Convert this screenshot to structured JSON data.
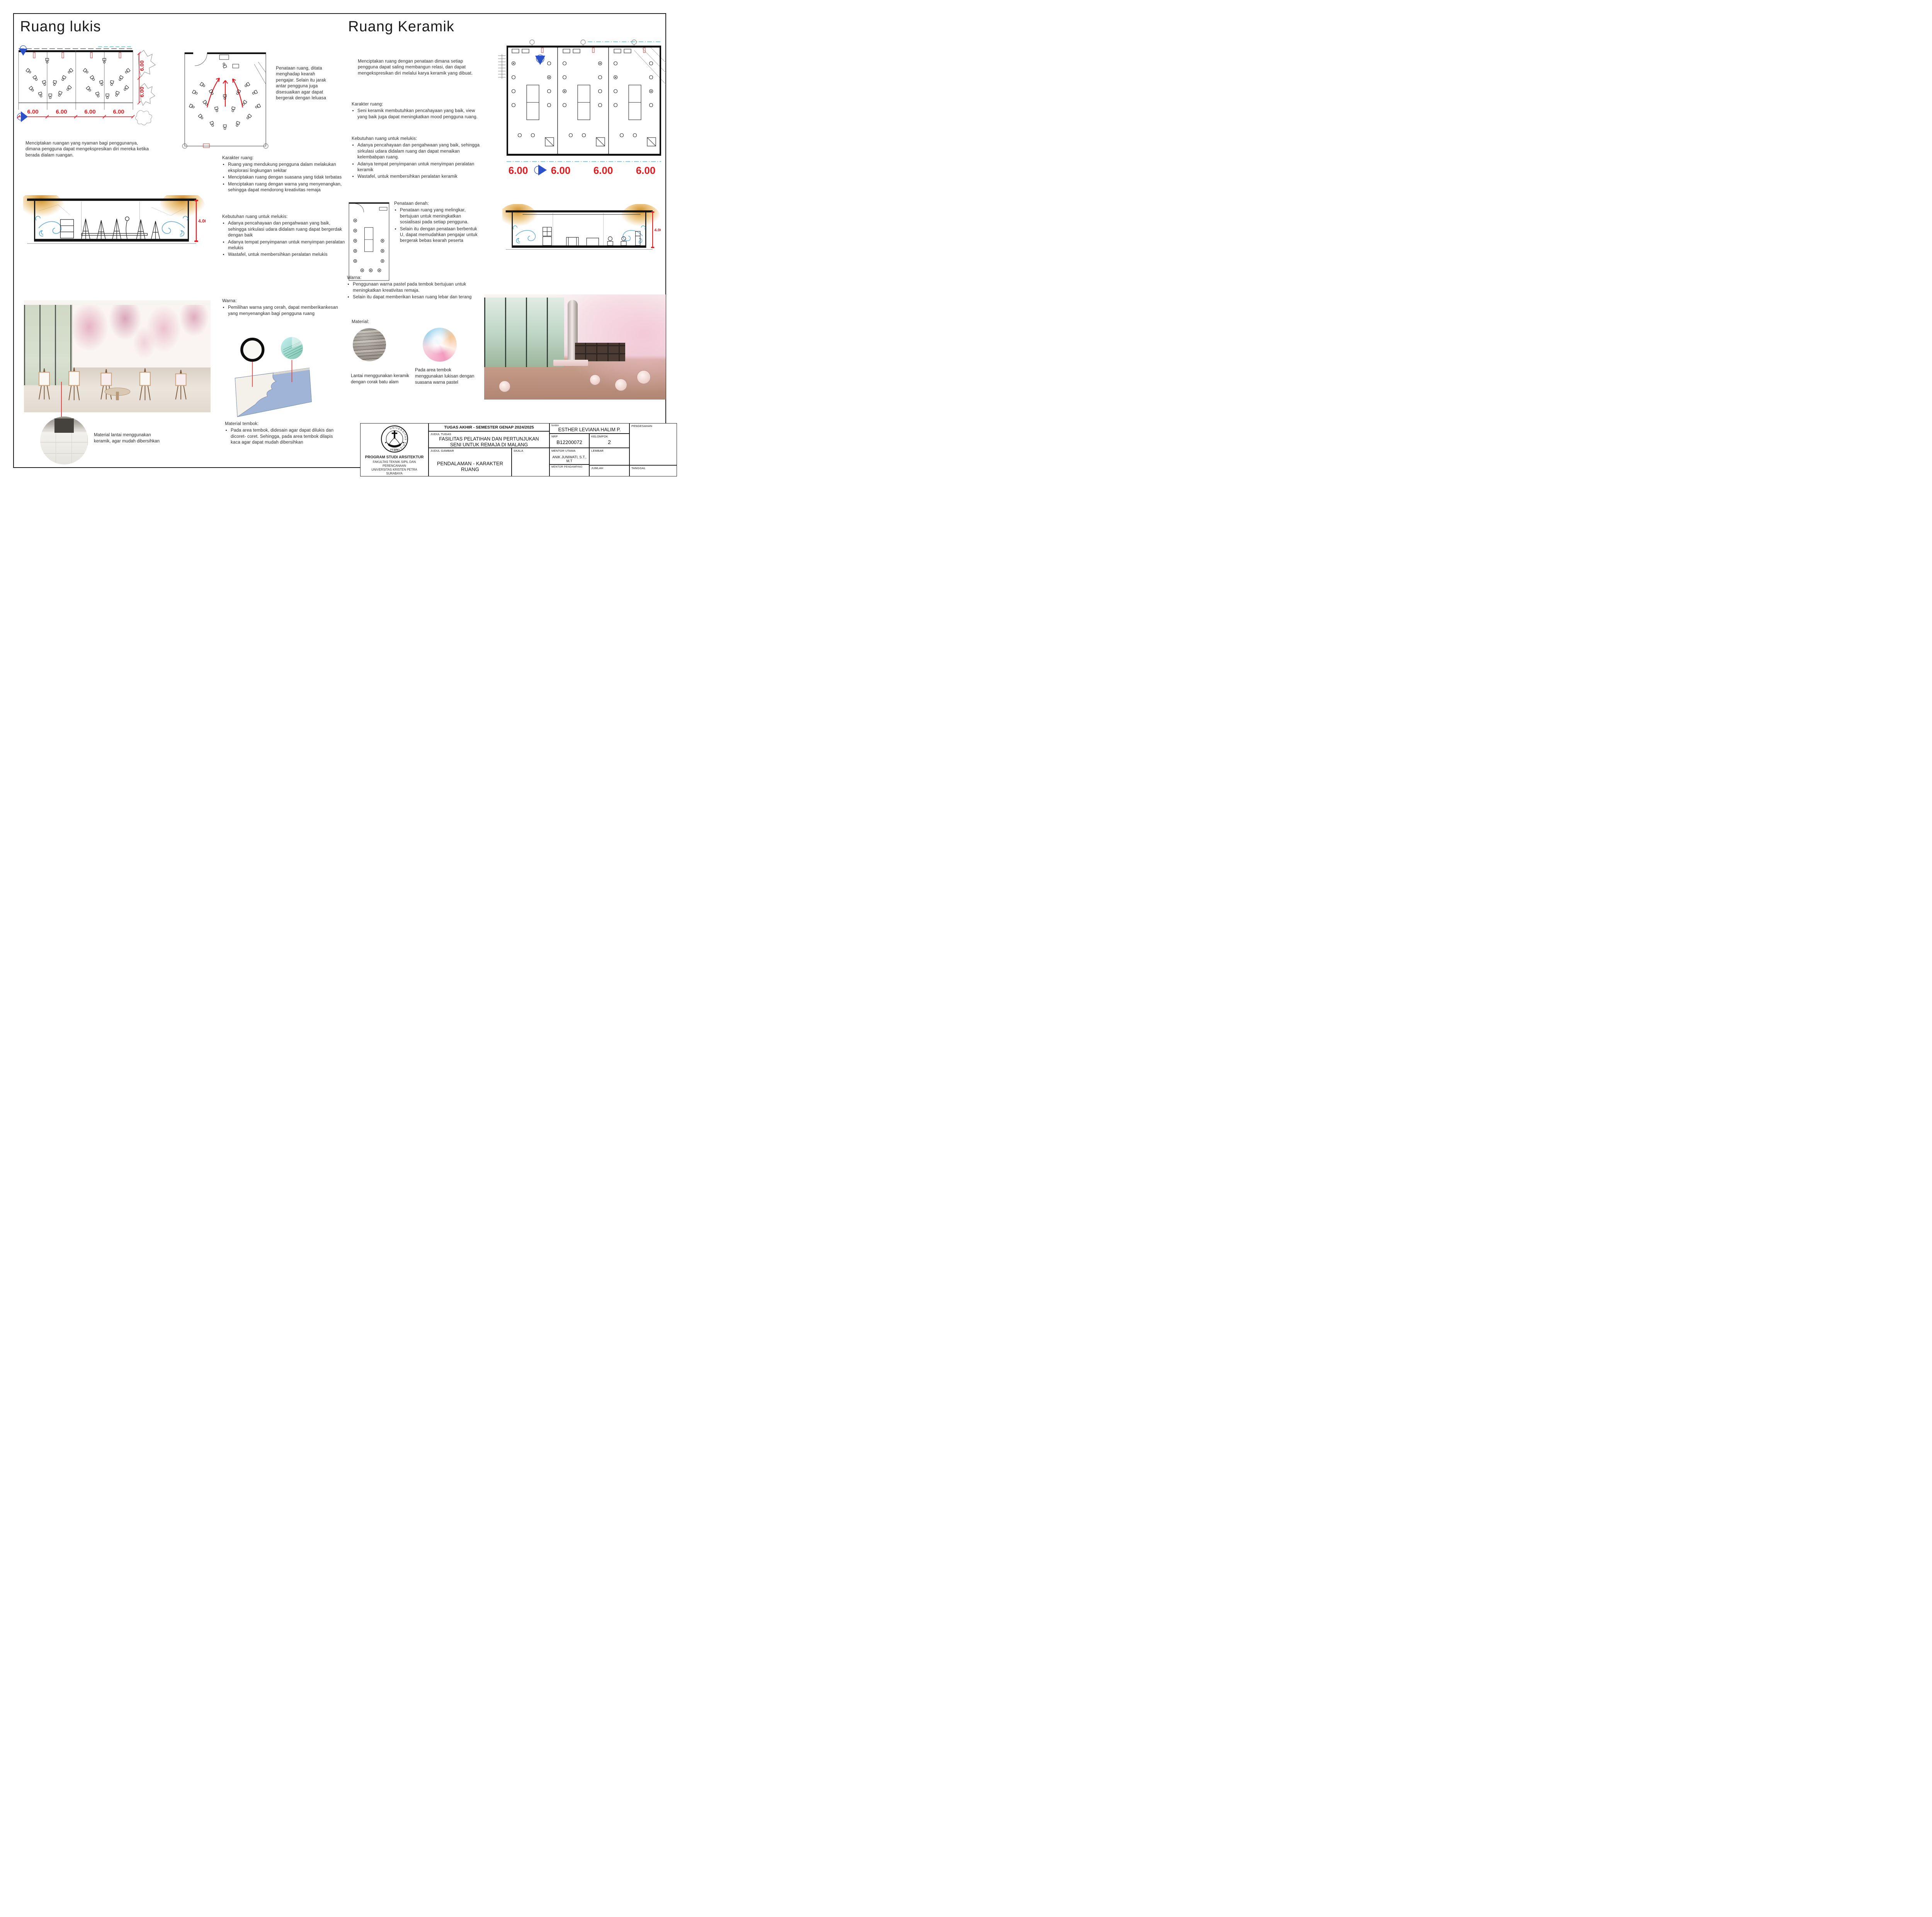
{
  "colors": {
    "dim_red": "#e8191f",
    "marker_blue": "#2b50c8",
    "wind_blue": "#5aa7d6",
    "glow_orange": "#dd8f1c",
    "panel_blue": "#9fb4d6",
    "glass_teal": "#9fd8cb"
  },
  "left": {
    "title": "Ruang lukis",
    "plan_dims": [
      "6.00",
      "6.00",
      "6.00",
      "6.00"
    ],
    "plan_vdims": [
      "6.00",
      "6.00"
    ],
    "intro": "Menciptakan ruangan yang nyaman bagi penggunanya, dimana pengguna dapat mengekspresikan diri mereka ketika berada dialam ruangan.",
    "annotation": "Penataan ruang, ditata menghadap kearah pengajar. Selain itu jarak antar pengguna juga disesuaikan agar dapat bergerak dengan leluasa",
    "section_dim": "4.00",
    "karakter": {
      "heading": "Karakter ruang:",
      "items": [
        "Ruang yang mendukung pengguna dalam melakukan eksplorasi lingkungan sekitar",
        "Menciptakan ruang dengan suasana yang tidak terbatas",
        "Menciptakan ruang dengan warna yang menyenangkan, sehingga dapat mendorong kreativitas remaja"
      ]
    },
    "kebutuhan": {
      "heading": "Kebutuhan ruang untuk melukis:",
      "items": [
        "Adanya pencahayaan dan pengahwaan yang baik, sehingga sirkulasi udara didalam ruang dapat bergerdak dengan baik",
        "Adanya tempat penyimpanan untuk menyimpan peralatan melukis",
        "Wastafel, untuk membersihkan peralatan melukis"
      ]
    },
    "warna": {
      "heading": "Warna:",
      "items": [
        "Pemilihan warna yang cerah, dapat memberikankesan yang menyenangkan bagi pengguna ruang"
      ]
    },
    "material_tembok": {
      "heading": "Material tembok:",
      "items": [
        "Pada area tembok, didesain agar dapat dilukis dan dicoret- coret. Sehingga, pada area tembok dilapis kaca agar dapat mudah dibersihkan"
      ]
    },
    "material_lantai": "Material lantai menggunakan keramik, agar mudah dibersihkan"
  },
  "right": {
    "title": "Ruang Keramik",
    "plan_dims": [
      "6.00",
      "6.00",
      "6.00",
      "6.00"
    ],
    "intro": "Menciptakan ruang dengan penataan dimana setiap pengguna dapat saling membangun relasi, dan dapat mengekspresikan diri melalui karya keramik yang dibuat.",
    "section_dim": "4.00",
    "karakter": {
      "heading": "Karakter ruang:",
      "items": [
        "Seni keramik membutuhkan pencahayaan yang baik, view yang baik juga dapat meningkatkan mood pengguna ruang."
      ]
    },
    "kebutuhan": {
      "heading": "Kebutuhan ruang untuk melukis:",
      "items": [
        "Adanya pencahayaan dan pengahwaan yang baik, sehingga sirkulasi udara didalam ruang dan dapat menaikan kelembabpan ruang.",
        "Adanya tempat penyimpanan untuk menyimpan peralatan keramik",
        "Wastafel, untuk membersihkan peralatan keramik"
      ]
    },
    "penataan": {
      "heading": "Penataan denah:",
      "items": [
        "Penataan ruang yang melingkar, bertujuan untuk meningkatkan sosialisasi pada setiap pengguna.",
        "Selain itu dengan penataan berbentuk U, dapat memudahkan pengajar untuk bergerak bebas kearah peserta"
      ]
    },
    "warna": {
      "heading": "Warna:",
      "items": [
        "Penggunaan warna pastel pada tembok bertujuan untuk meningkatkan kreativitas remaja.",
        "Selain itu dapat memberikan kesan ruang lebar dan terang"
      ]
    },
    "material_heading": "Material:",
    "material_captions": [
      "Lantai menggunakan keramik dengan corak batu alam",
      "Pada area tembok menggunakan lukisan dengan suasana warna pastel"
    ]
  },
  "titleblock": {
    "header": "TUGAS AKHIR - SEMESTER GENAP 2024/2025",
    "judul_tugas_label": "JUDUL TUGAS",
    "judul_tugas_line1": "FASILITAS PELATIHAN DAN PERTUNJUKAN",
    "judul_tugas_line2": "SENI UNTUK REMAJA DI MALANG",
    "judul_gambar_label": "JUDUL GAMBAR",
    "judul_gambar": "PENDALAMAN - KARAKTER RUANG",
    "skala_label": "SKALA",
    "nama_label": "NAMA",
    "nama": "ESTHER LEVIANA HALIM P.",
    "nrp_label": "NRP",
    "nrp": "B12200072",
    "kelompok_label": "KELOMPOK",
    "kelompok": "2",
    "mentor_utama_label": "MENTOR UTAMA",
    "mentor_utama": "ANIK JUNIWATI, S.T., M.T",
    "mentor_pendamping_label": "MENTOR PENDAMPING",
    "lembar_label": "LEMBAR",
    "jumlah_label": "JUMLAH",
    "tanggal_label": "TANGGAL",
    "pengesahan_label": "PENGESAHAN",
    "logo_top": "UNIVERSITAS KRISTEN",
    "logo_bottom": "PETRA",
    "institution_line1": "PROGRAM STUDI ARSITEKTUR",
    "institution_line2": "FAKULTAS TEKNIK SIPIL DAN PERENCANAAN",
    "institution_line3": "UNIVERSITAS KRISTEN PETRA",
    "institution_line4": "SURABAYA"
  }
}
